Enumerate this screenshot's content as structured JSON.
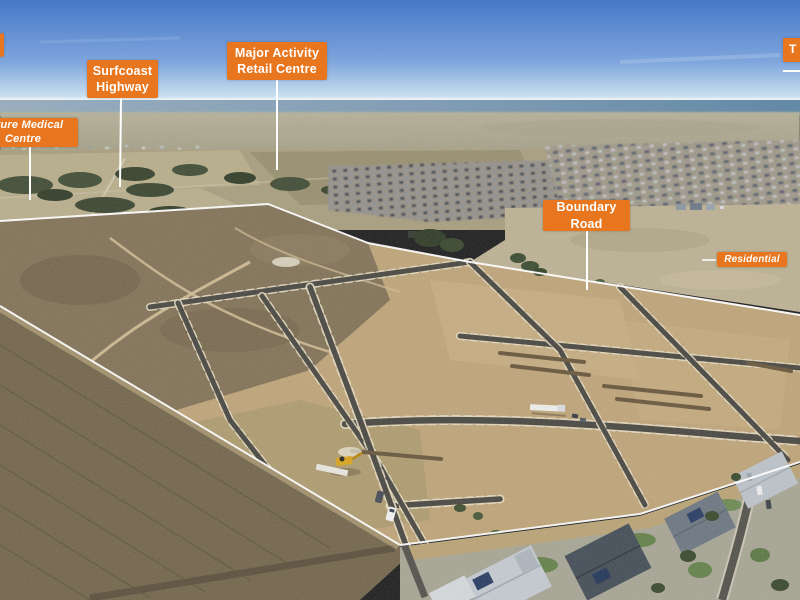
{
  "annotations": {
    "surfcoast_highway": {
      "line1": "Surfcoast",
      "line2": "Highway"
    },
    "major_activity_retail_centre": {
      "line1": "Major Activity",
      "line2": "Retail Centre"
    },
    "future_medical_centre": {
      "line1": "Future Medical",
      "line2": "Centre"
    },
    "boundary_road": {
      "line1": "Boundary",
      "line2": "Road"
    },
    "residential": {
      "text": "Residential"
    },
    "top_right_partial": {
      "text": "T"
    }
  },
  "colors": {
    "label_background": "#E8761F",
    "label_text": "#FFFFFF",
    "leader_line": "#FFFFFF",
    "site_boundary_line": "#FFFFFF",
    "sky_top": "#4678C8",
    "sky_horizon": "#C9DEEF",
    "ocean": "#7E9BB4",
    "site_dirt": "#BFA57B",
    "rough_terrain": "#84755A",
    "road_surface": "#4C4A44",
    "road_kerb": "#E6DCC2"
  }
}
